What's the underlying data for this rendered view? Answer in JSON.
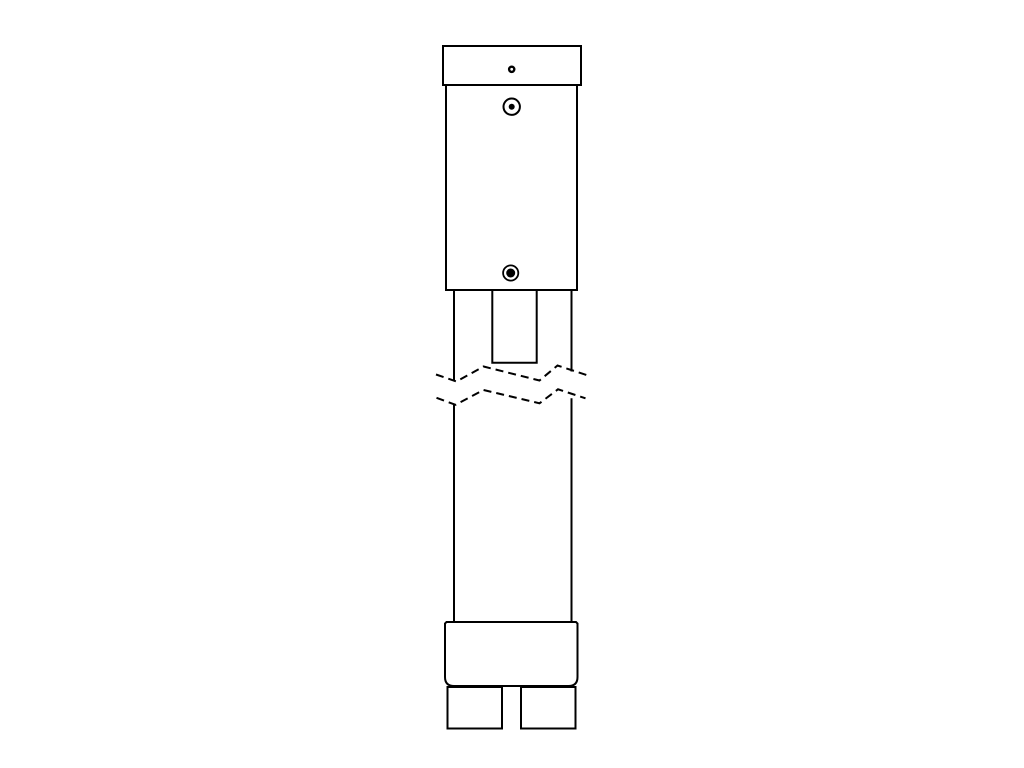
{
  "drawing": {
    "description": "technical-line-drawing-of-vertical-probe-assembly-with-break-symbol",
    "canvas_width": 1024,
    "canvas_height": 768,
    "background_color": "#ffffff",
    "stroke_color": "#000000",
    "stroke_width": 2,
    "dash_pattern": "8 5"
  },
  "shapes": [
    {
      "name": "top-cap",
      "type": "rect",
      "x": 443,
      "y": 46,
      "w": 138,
      "h": 39
    },
    {
      "name": "cap-hole",
      "type": "circle",
      "cx": 511.7,
      "cy": 69.3,
      "r": 2.6,
      "sw": 2.4
    },
    {
      "name": "main-body",
      "type": "rect",
      "x": 446,
      "y": 85,
      "w": 131,
      "h": 205
    },
    {
      "name": "upper-port-ring",
      "type": "circle",
      "cx": 511.7,
      "cy": 106.7,
      "r": 8.2,
      "sw": 2
    },
    {
      "name": "upper-port-dot",
      "type": "circle",
      "cx": 511.7,
      "cy": 106.7,
      "r": 3,
      "fill": "#000000",
      "sw": 0
    },
    {
      "name": "lower-screw-ring",
      "type": "circle",
      "cx": 510.7,
      "cy": 273,
      "r": 7.6,
      "sw": 1.8
    },
    {
      "name": "lower-screw-core",
      "type": "circle",
      "cx": 510.7,
      "cy": 273,
      "r": 4.5,
      "fill": "#000000",
      "sw": 0
    },
    {
      "name": "neck-left-edge",
      "type": "line",
      "x1": 454,
      "y1": 290,
      "x2": 454,
      "y2": 381
    },
    {
      "name": "neck-right-edge",
      "type": "line",
      "x1": 571.5,
      "y1": 290,
      "x2": 571.5,
      "y2": 371.5
    },
    {
      "name": "neck-slot",
      "type": "path",
      "d": "M492.3,290 L492.3,362.8 L536.7,362.8 L536.7,290"
    },
    {
      "name": "break-line-upper",
      "type": "polyline",
      "dashed": true,
      "points": "436,374.5 456.5,381.5 483.5,366.5 539.5,380.5 557.5,365.5 586.5,375"
    },
    {
      "name": "break-line-lower",
      "type": "polyline",
      "dashed": true,
      "points": "436.5,397.8 455.5,404.8 483.5,390 539.5,403.3 558,389.3 585.5,398.3"
    },
    {
      "name": "shaft-left-edge",
      "type": "line",
      "x1": 454,
      "y1": 404.8,
      "x2": 454,
      "y2": 622
    },
    {
      "name": "shaft-right-edge",
      "type": "line",
      "x1": 571.5,
      "y1": 398.3,
      "x2": 571.5,
      "y2": 622
    },
    {
      "name": "base-block",
      "type": "path",
      "d": "M446.5,622 L576,622 L577.5,623.5 L577.5,677 Q577.5,686 568.5,686 L454,686 Q445,686 445,677 L445,623.5 Z"
    },
    {
      "name": "left-foot",
      "type": "rect",
      "x": 447.5,
      "y": 687,
      "w": 54.5,
      "h": 41.5
    },
    {
      "name": "right-foot",
      "type": "rect",
      "x": 521,
      "y": 687,
      "w": 54.5,
      "h": 41.5
    }
  ]
}
